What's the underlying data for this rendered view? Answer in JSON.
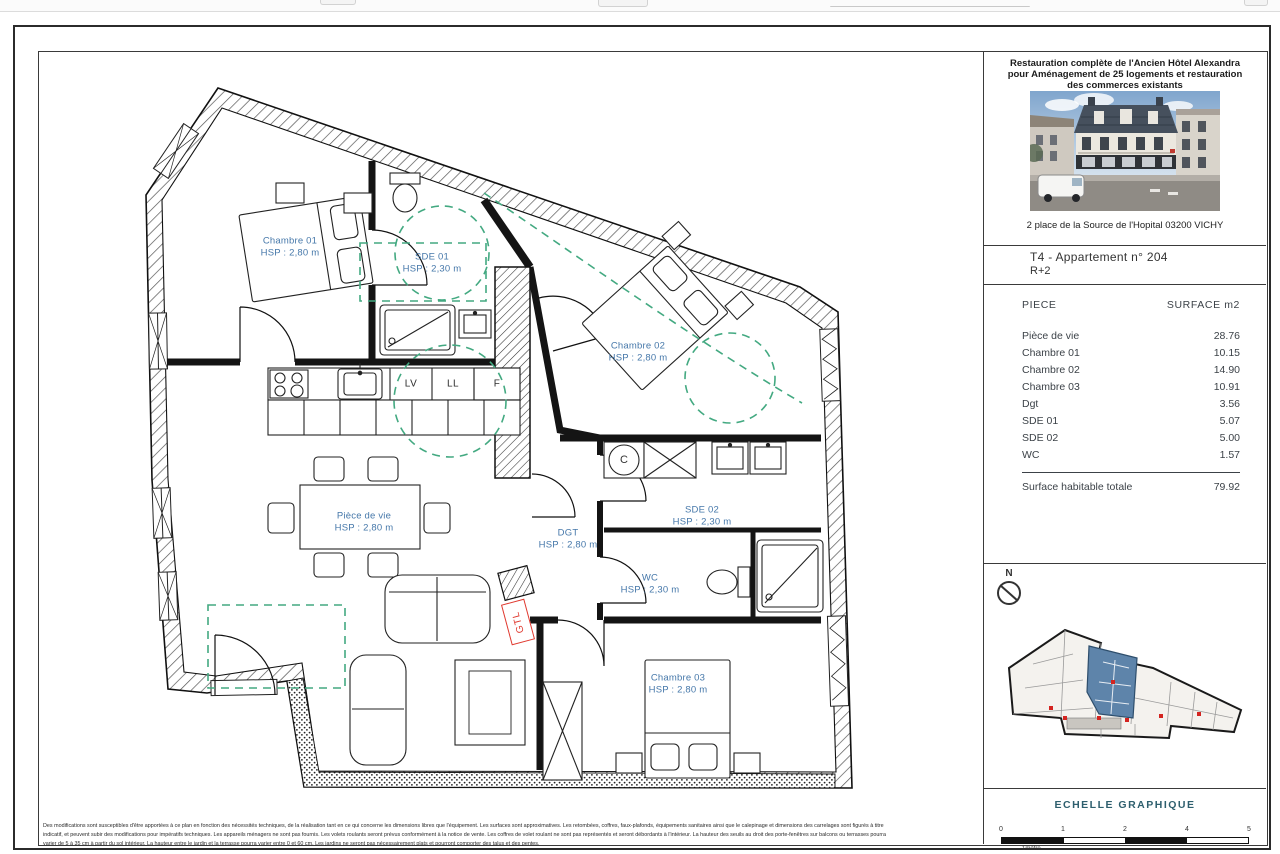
{
  "title_block": {
    "project_title_lines": [
      "Restauration complète de l'Ancien Hôtel Alexandra",
      "pour Aménagement de 25 logements et restauration",
      "des commerces existants"
    ],
    "address": "2 place de la Source de l'Hopital 03200 VICHY",
    "apartment_ref": "T4 - Appartement n° 204",
    "floor_ref": "R+2",
    "surface_table": {
      "header_piece": "PIECE",
      "header_surface": "SURFACE m2",
      "rows": [
        {
          "piece": "Pièce de vie",
          "surface": "28.76"
        },
        {
          "piece": "Chambre 01",
          "surface": "10.15"
        },
        {
          "piece": "Chambre 02",
          "surface": "14.90"
        },
        {
          "piece": "Chambre 03",
          "surface": "10.91"
        },
        {
          "piece": "Dgt",
          "surface": "3.56"
        },
        {
          "piece": "SDE 01",
          "surface": "5.07"
        },
        {
          "piece": "SDE 02",
          "surface": "5.00"
        },
        {
          "piece": "WC",
          "surface": "1.57"
        }
      ],
      "total_label": "Surface habitable totale",
      "total_value": "79.92"
    },
    "north_label": "N",
    "scale": {
      "title": "ECHELLE GRAPHIQUE",
      "ticks": [
        "0",
        "1",
        "2",
        "4",
        "5"
      ],
      "unit_label": "1mètre"
    }
  },
  "floor_plan": {
    "rooms": [
      {
        "name": "Chambre 01",
        "hsp": "HSP : 2,80 m"
      },
      {
        "name": "SDE 01",
        "hsp": "HSP : 2,30 m"
      },
      {
        "name": "Chambre 02",
        "hsp": "HSP : 2,80 m"
      },
      {
        "name": "Pièce de vie",
        "hsp": "HSP : 2,80 m"
      },
      {
        "name": "DGT",
        "hsp": "HSP : 2,80 m"
      },
      {
        "name": "SDE 02",
        "hsp": "HSP : 2,30 m"
      },
      {
        "name": "WC",
        "hsp": "HSP : 2,30 m"
      },
      {
        "name": "Chambre 03",
        "hsp": "HSP : 2,80 m"
      }
    ],
    "appliances": [
      "LV",
      "LL",
      "F"
    ],
    "gtl_label": "GTL",
    "water_heater_label": "C"
  },
  "disclaimer_lines": [
    "Des modifications sont susceptibles d'être apportées à ce plan en fonction des nécessités techniques, de la réalisation tant en ce qui concerne les dimensions libres que l'équipement. Les surfaces sont approximatives. Les retombées, coffres, faux-plafonds, équipements sanitaires ainsi que le calepinage et dimensions des carrelages sont figurés à titre",
    "indicatif, et peuvent subir des modifications pour impératifs techniques. Les appareils ménagers ne sont pas fournis. Les volets roulants seront prévus conformément à la notice de vente. Les coffres de volet roulant ne sont pas représentés et seront débordants à l'intérieur. La hauteur des seuils au droit des porte-fenêtres sur balcons ou terrasses pourra",
    "varier de 5 à 35 cm à partir du sol intérieur. La hauteur entre le jardin et la terrasse pourra varier entre 0 et 60 cm. Les jardins ne seront pas nécessairement plats et pourront comporter des talus et des pentes."
  ],
  "colors": {
    "room-label": "#4678aa",
    "green-dashed": "#43a981",
    "gtl-red": "#e0392f",
    "scale-title": "#2e5f6e",
    "highlight-unit": "#5e84aa"
  }
}
